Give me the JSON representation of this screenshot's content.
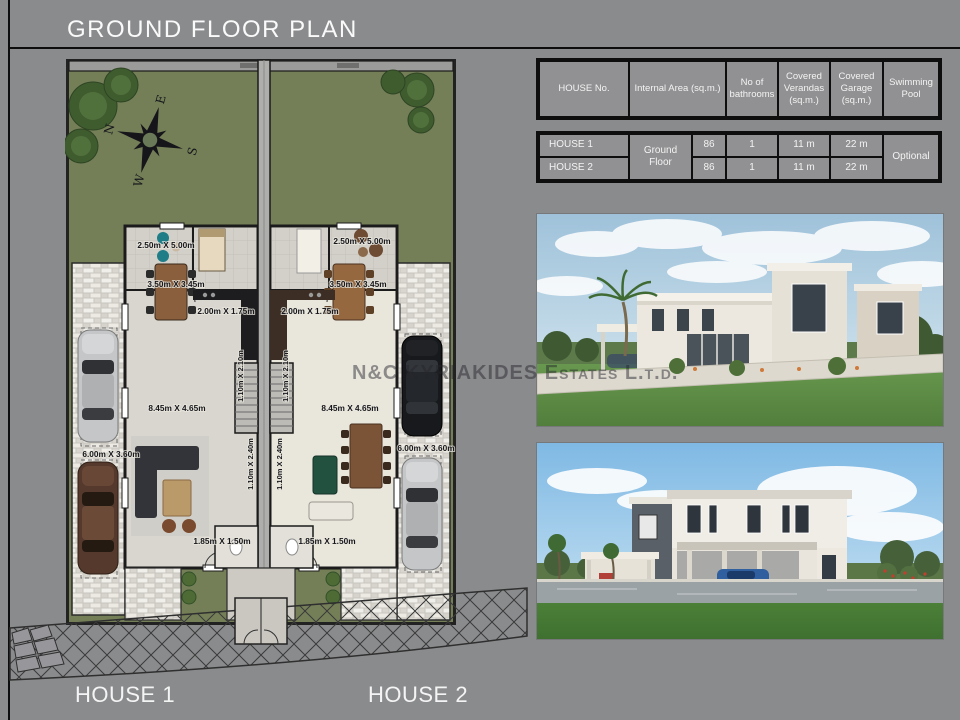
{
  "page": {
    "title": "GROUND FLOOR PLAN"
  },
  "watermark": "N&C KYRIAKIDES Estates L.t.d.",
  "spec_table": {
    "headers": [
      "HOUSE No.",
      "Internal Area (sq.m.)",
      "No of bathrooms",
      "Covered Verandas (sq.m.)",
      "Covered Garage (sq.m.)",
      "Swimming Pool"
    ],
    "floor_scope": "Ground Floor",
    "pool_value": "Optional",
    "rows": [
      {
        "house": "HOUSE 1",
        "internal_area": "86",
        "bathrooms": "1",
        "verandas": "11 m",
        "garage": "22 m"
      },
      {
        "house": "HOUSE 2",
        "internal_area": "86",
        "bathrooms": "1",
        "verandas": "11 m",
        "garage": "22 m"
      }
    ]
  },
  "floor_plan": {
    "dims": {
      "bedroom": "2.50m X 5.00m",
      "dining": "3.50m X 3.45m",
      "kitchen": "2.00m X 1.75m",
      "living": "8.45m X 4.65m",
      "garage": "6.00m X 3.60m",
      "wc": "1.85m X 1.50m",
      "hall": "1.10m X 2.10m",
      "stair": "1.10m X 2.40m"
    },
    "compass": {
      "n": "N",
      "e": "E",
      "s": "S",
      "w": "W"
    }
  },
  "footer": {
    "house1": "HOUSE 1",
    "house2": "HOUSE 2"
  }
}
